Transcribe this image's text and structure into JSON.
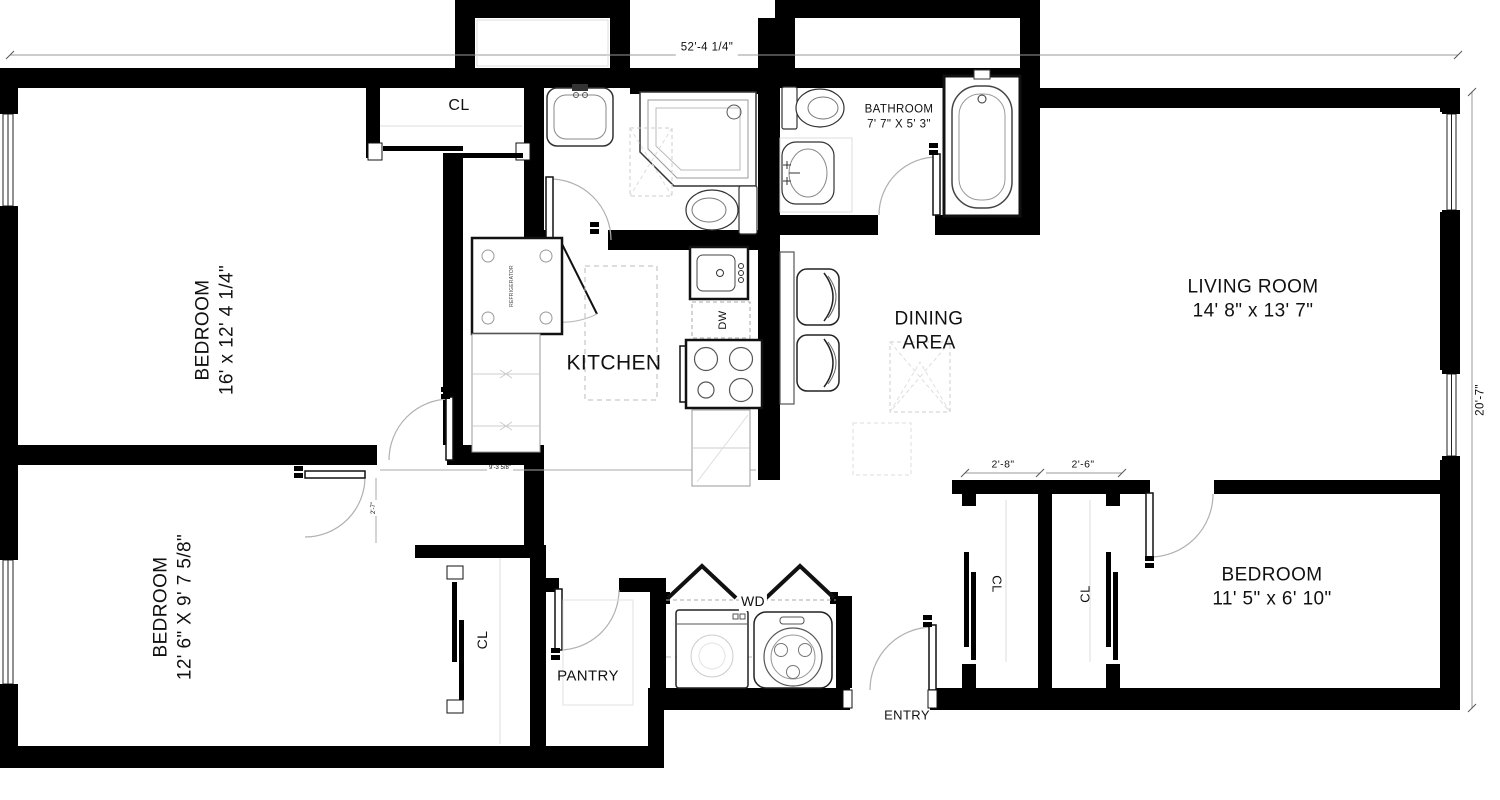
{
  "title": "Apartment floor plan",
  "labels": {
    "bedroom1": {
      "name": "BEDROOM",
      "size": "16' x 12' 4 1/4\""
    },
    "bedroom2": {
      "name": "BEDROOM",
      "size": "12' 6\" X 9' 7 5/8\""
    },
    "bedroom3": {
      "name": "BEDROOM",
      "size": "11' 5\" x 6' 10\""
    },
    "living_room": {
      "name": "LIVING ROOM",
      "size": "14' 8\" x 13' 7\""
    },
    "dining_area": {
      "line1": "DINING",
      "line2": "AREA"
    },
    "kitchen": {
      "name": "KITCHEN"
    },
    "bathroom": {
      "name": "BATHROOM",
      "size": "7' 7\" X 5' 3\""
    },
    "pantry": {
      "name": "PANTRY"
    },
    "entry": {
      "name": "ENTRY"
    },
    "washer_dryer": {
      "name": "WD"
    },
    "dishwasher": {
      "name": "DW"
    },
    "refrigerator": {
      "name": "REFRIGERATOR"
    },
    "closet_top": {
      "name": "CL"
    },
    "closet_bedroom2": {
      "name": "CL"
    },
    "closet_entry_left": {
      "name": "CL"
    },
    "closet_entry_right": {
      "name": "CL"
    }
  },
  "dimensions": {
    "overall_width": "52'-4 1/4\"",
    "overall_depth": "20'-7\"",
    "entry_closet_left": "2'-8\"",
    "entry_closet_right": "2'-6\"",
    "kitchen_passage": "9'-3 5/8\"",
    "door_offset": "2'-7\""
  },
  "colors": {
    "wall": "#000000",
    "background": "#ffffff",
    "fixture_stroke": "#333333",
    "light_line": "#bbbbbb",
    "swing_arc": "#b0b0b0",
    "text": "#111111"
  }
}
